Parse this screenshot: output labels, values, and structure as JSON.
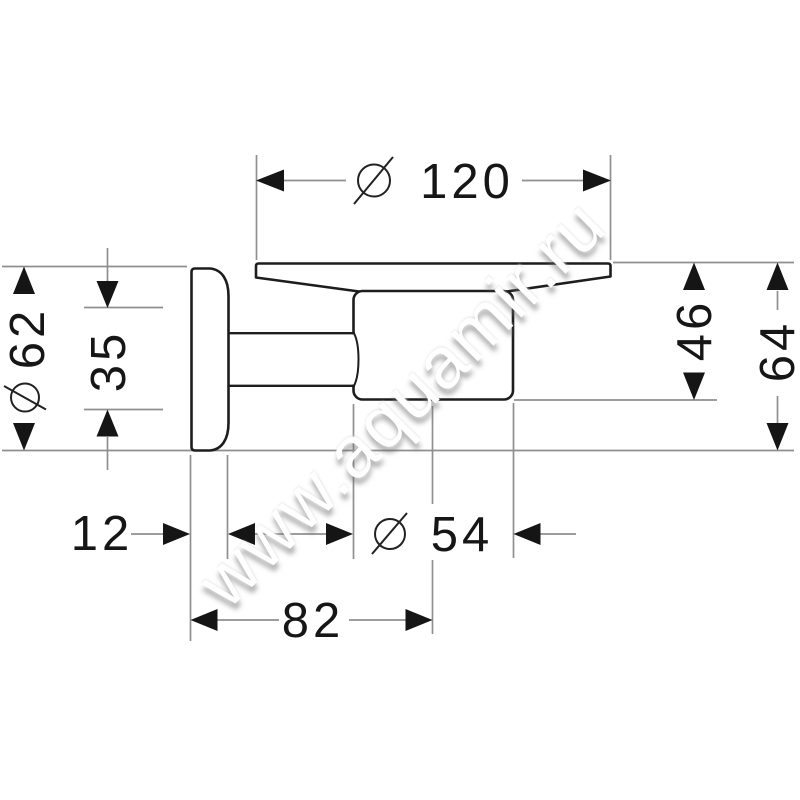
{
  "page": {
    "type": "technical dimension drawing",
    "subject": "wall-mounted soap dish holder, side elevation",
    "background": "#ffffff"
  },
  "drawing": {
    "dimensions": {
      "dish_diameter": "120",
      "rosette_diameter": "62",
      "rosette_inner_offset": "35",
      "drop_to_cup_bottom": "46",
      "drop_to_rosette_bottom": "64",
      "rosette_thickness": "12",
      "cup_diameter": "54",
      "wall_to_cup_center": "82"
    },
    "symbols": {
      "diameter_symbol": "circle-with-slash"
    }
  },
  "watermark": {
    "text": "www.aquamir.ru"
  },
  "colors": {
    "outline": "#1d1d1d",
    "dimension_lines": "#8f8f8f",
    "ink": "#161616",
    "watermark_text": "#ffffff"
  }
}
